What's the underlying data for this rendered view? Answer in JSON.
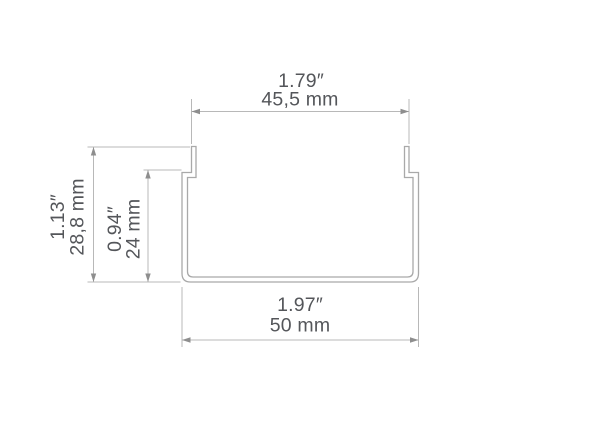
{
  "diagram": {
    "title": "U-channel profile cross-section drawing",
    "dimensions": {
      "inner_width": {
        "inches": "1.79″",
        "mm": "45,5 mm"
      },
      "outer_width": {
        "inches": "1.97″",
        "mm": "50 mm"
      },
      "outer_height": {
        "inches": "1.13″",
        "mm": "28,8 mm"
      },
      "inner_height": {
        "inches": "0.94″",
        "mm": "24 mm"
      }
    },
    "colors": {
      "background": "#ffffff",
      "profile_line": "#a9a9a9",
      "dimension_line": "#b8b8b8",
      "arrow": "#8e8e8e",
      "text": "#54565a"
    }
  }
}
